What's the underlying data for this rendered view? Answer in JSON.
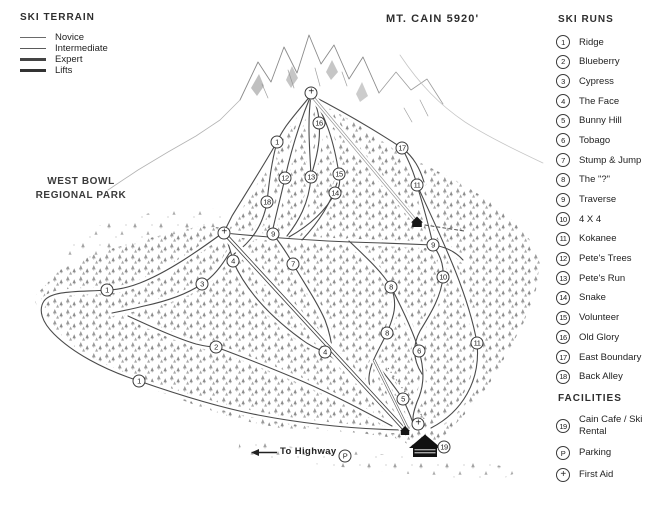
{
  "title": "MT. CAIN 5920'",
  "legend": {
    "header": "SKI TERRAIN",
    "items": [
      {
        "label": "Novice"
      },
      {
        "label": "Intermediate"
      },
      {
        "label": "Expert"
      },
      {
        "label": "Lifts"
      }
    ]
  },
  "park_label": {
    "line1": "WEST BOWL",
    "line2": "REGIONAL PARK"
  },
  "ski_runs": {
    "header": "SKI RUNS",
    "items": [
      {
        "id": "1",
        "label": "Ridge"
      },
      {
        "id": "2",
        "label": "Blueberry"
      },
      {
        "id": "3",
        "label": "Cypress"
      },
      {
        "id": "4",
        "label": "The Face"
      },
      {
        "id": "5",
        "label": "Bunny Hill"
      },
      {
        "id": "6",
        "label": "Tobago"
      },
      {
        "id": "7",
        "label": "Stump & Jump"
      },
      {
        "id": "8",
        "label": "The \"?\""
      },
      {
        "id": "9",
        "label": "Traverse"
      },
      {
        "id": "10",
        "label": "4 X 4"
      },
      {
        "id": "11",
        "label": "Kokanee"
      },
      {
        "id": "12",
        "label": "Pete's Trees"
      },
      {
        "id": "13",
        "label": "Pete's Run"
      },
      {
        "id": "14",
        "label": "Snake"
      },
      {
        "id": "15",
        "label": "Volunteer"
      },
      {
        "id": "16",
        "label": "Old Glory"
      },
      {
        "id": "17",
        "label": "East Boundary"
      },
      {
        "id": "18",
        "label": "Back Alley"
      }
    ]
  },
  "facilities": {
    "header": "FACILITIES",
    "items": [
      {
        "id": "19",
        "label": "Cain Cafe / Ski Rental"
      },
      {
        "id": "P",
        "label": "Parking"
      },
      {
        "id": "+",
        "label": "First Aid"
      }
    ]
  },
  "base": {
    "to_highway": "To Highway"
  },
  "map_markers": [
    {
      "id": "+",
      "x": 311,
      "y": 93
    },
    {
      "id": "16",
      "x": 319,
      "y": 123
    },
    {
      "id": "1",
      "x": 277,
      "y": 142
    },
    {
      "id": "17",
      "x": 402,
      "y": 148
    },
    {
      "id": "15",
      "x": 339,
      "y": 174
    },
    {
      "id": "13",
      "x": 311,
      "y": 177
    },
    {
      "id": "12",
      "x": 285,
      "y": 178
    },
    {
      "id": "11",
      "x": 417,
      "y": 185
    },
    {
      "id": "14",
      "x": 335,
      "y": 193
    },
    {
      "id": "18",
      "x": 267,
      "y": 202
    },
    {
      "id": "+",
      "x": 224,
      "y": 233
    },
    {
      "id": "9",
      "x": 273,
      "y": 234
    },
    {
      "id": "9",
      "x": 433,
      "y": 245
    },
    {
      "id": "4",
      "x": 233,
      "y": 261
    },
    {
      "id": "7",
      "x": 293,
      "y": 264
    },
    {
      "id": "10",
      "x": 443,
      "y": 277
    },
    {
      "id": "3",
      "x": 202,
      "y": 284
    },
    {
      "id": "8",
      "x": 391,
      "y": 287
    },
    {
      "id": "1",
      "x": 107,
      "y": 290
    },
    {
      "id": "8",
      "x": 387,
      "y": 333
    },
    {
      "id": "11",
      "x": 477,
      "y": 343
    },
    {
      "id": "2",
      "x": 216,
      "y": 347
    },
    {
      "id": "6",
      "x": 419,
      "y": 351
    },
    {
      "id": "4",
      "x": 325,
      "y": 352
    },
    {
      "id": "1",
      "x": 139,
      "y": 381
    },
    {
      "id": "5",
      "x": 403,
      "y": 399
    },
    {
      "id": "+",
      "x": 418,
      "y": 424
    },
    {
      "id": "19",
      "x": 444,
      "y": 447
    },
    {
      "id": "P",
      "x": 345,
      "y": 456
    }
  ],
  "colors": {
    "ink": "#2e2e2e",
    "trail_line": "#4a4a4a",
    "tree_gray": "#9a9a9a",
    "building_black": "#161616"
  }
}
